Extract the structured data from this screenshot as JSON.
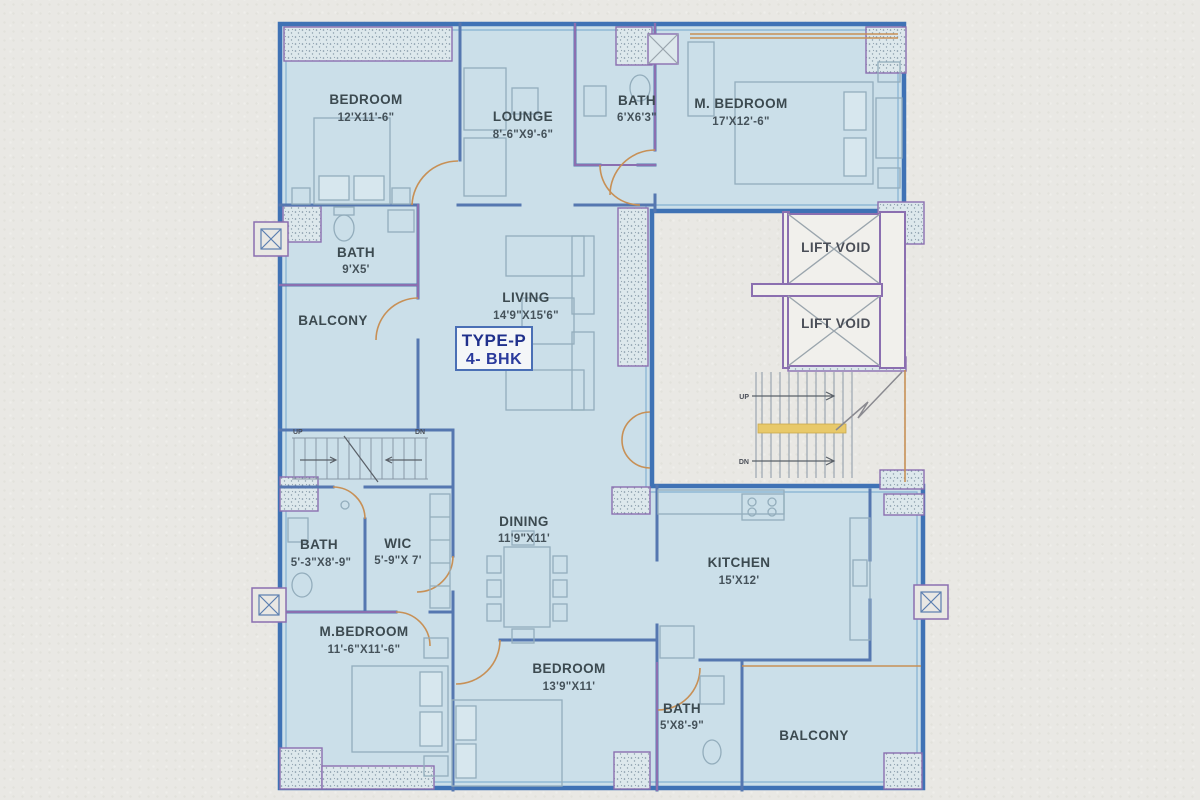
{
  "plan_title_box": {
    "line1": "TYPE-P",
    "line2": "4- BHK"
  },
  "rooms": [
    {
      "name": "BEDROOM",
      "dims": "12'X11'-6\""
    },
    {
      "name": "LOUNGE",
      "dims": "8'-6\"X9'-6\""
    },
    {
      "name": "BATH",
      "dims": "6'X6'3\""
    },
    {
      "name": "M. BEDROOM",
      "dims": "17'X12'-6\""
    },
    {
      "name": "BATH",
      "dims": "9'X5'"
    },
    {
      "name": "BALCONY",
      "dims": ""
    },
    {
      "name": "LIVING",
      "dims": "14'9\"X15'6\""
    },
    {
      "name": "BATH",
      "dims": "5'-3\"X8'-9\""
    },
    {
      "name": "WIC",
      "dims": "5'-9\"X 7'"
    },
    {
      "name": "M.BEDROOM",
      "dims": "11'-6\"X11'-6\""
    },
    {
      "name": "DINING",
      "dims": "11'9\"X11'"
    },
    {
      "name": "KITCHEN",
      "dims": "15'X12'"
    },
    {
      "name": "BEDROOM",
      "dims": "13'9\"X11'"
    },
    {
      "name": "BATH",
      "dims": "5'X8'-9\""
    },
    {
      "name": "BALCONY",
      "dims": ""
    }
  ],
  "lifts": {
    "lift1": "LIFT VOID",
    "lift2": "LIFT VOID"
  },
  "stairs": {
    "left_up": "UP",
    "left_dn": "DN",
    "right_up": "UP",
    "right_dn": "DN"
  },
  "colors": {
    "paper": "#e9e8e4",
    "floor": "#cbdfe9",
    "outer_wall": "#3f72b5",
    "inner_wall": "#5577b0",
    "accent_purple": "#8b6fb0",
    "accent_tan": "#c79056",
    "label_text": "#3c4a50",
    "title_text": "#20308c",
    "stair_landing": "#e8c96a"
  }
}
